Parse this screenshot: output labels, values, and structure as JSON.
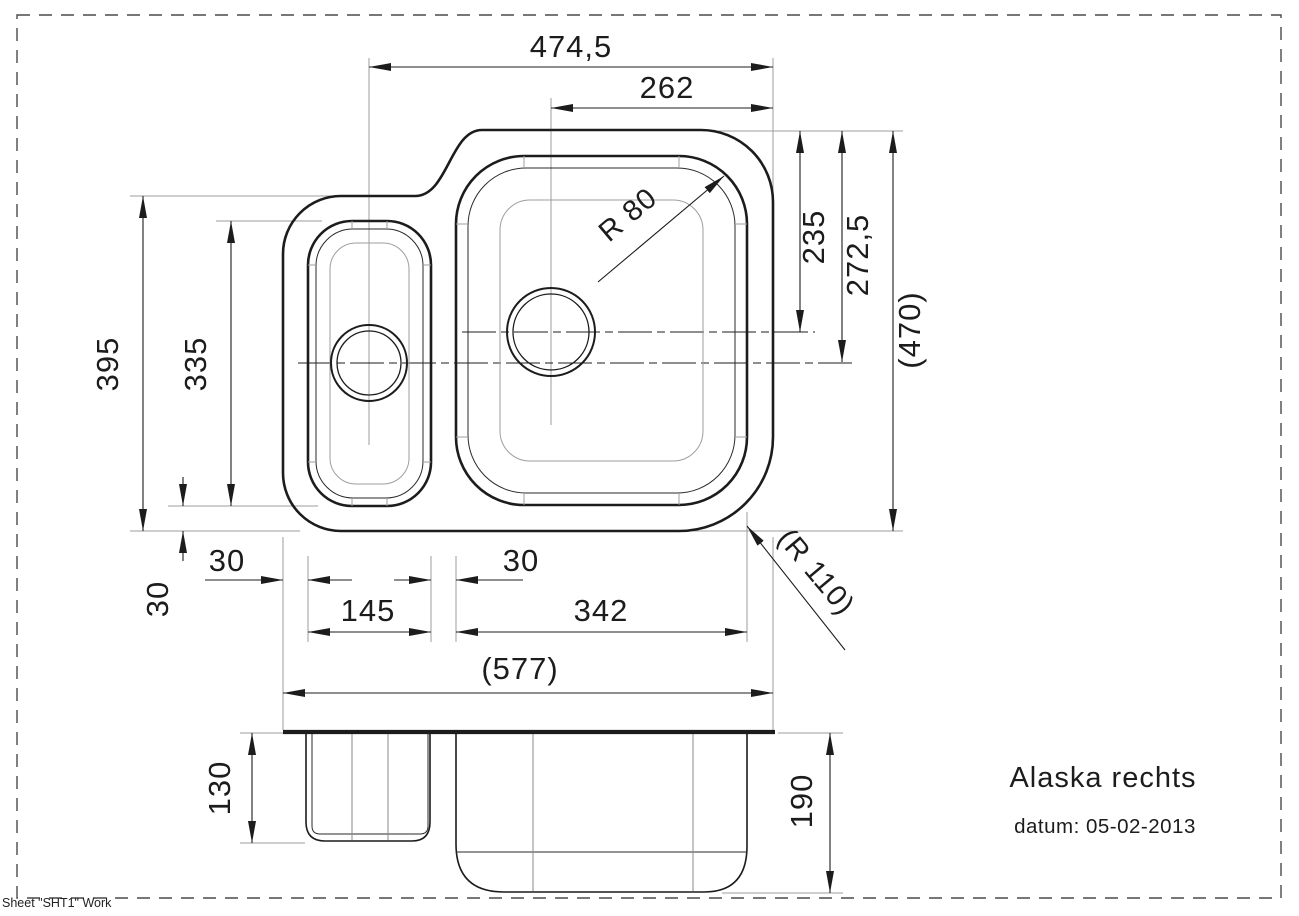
{
  "page": {
    "sheet_label": "Sheet \"SHT1\" Work"
  },
  "title_block": {
    "product_name": "Alaska rechts",
    "date": "datum: 05-02-2013"
  },
  "top_view": {
    "dim_overall_width": "474,5",
    "dim_drain_to_right_edge": "262",
    "dim_large_drain_from_top": "235",
    "dim_small_drain_from_top": "272,5",
    "dim_overall_depth_ref": "(470)",
    "dim_left_section_depth": "395",
    "dim_small_bowl_depth": "335",
    "dim_rim_bottom": "30",
    "dim_rim_left": "30",
    "dim_divider": "30",
    "dim_small_bowl_width": "145",
    "dim_large_bowl_width": "342",
    "dim_overall_width_ref": "(577)",
    "dim_bowl_corner_radius": "R 80",
    "dim_outer_corner_radius": "(R 110)"
  },
  "side_view": {
    "dim_small_bowl_depth": "130",
    "dim_large_bowl_depth": "190"
  }
}
